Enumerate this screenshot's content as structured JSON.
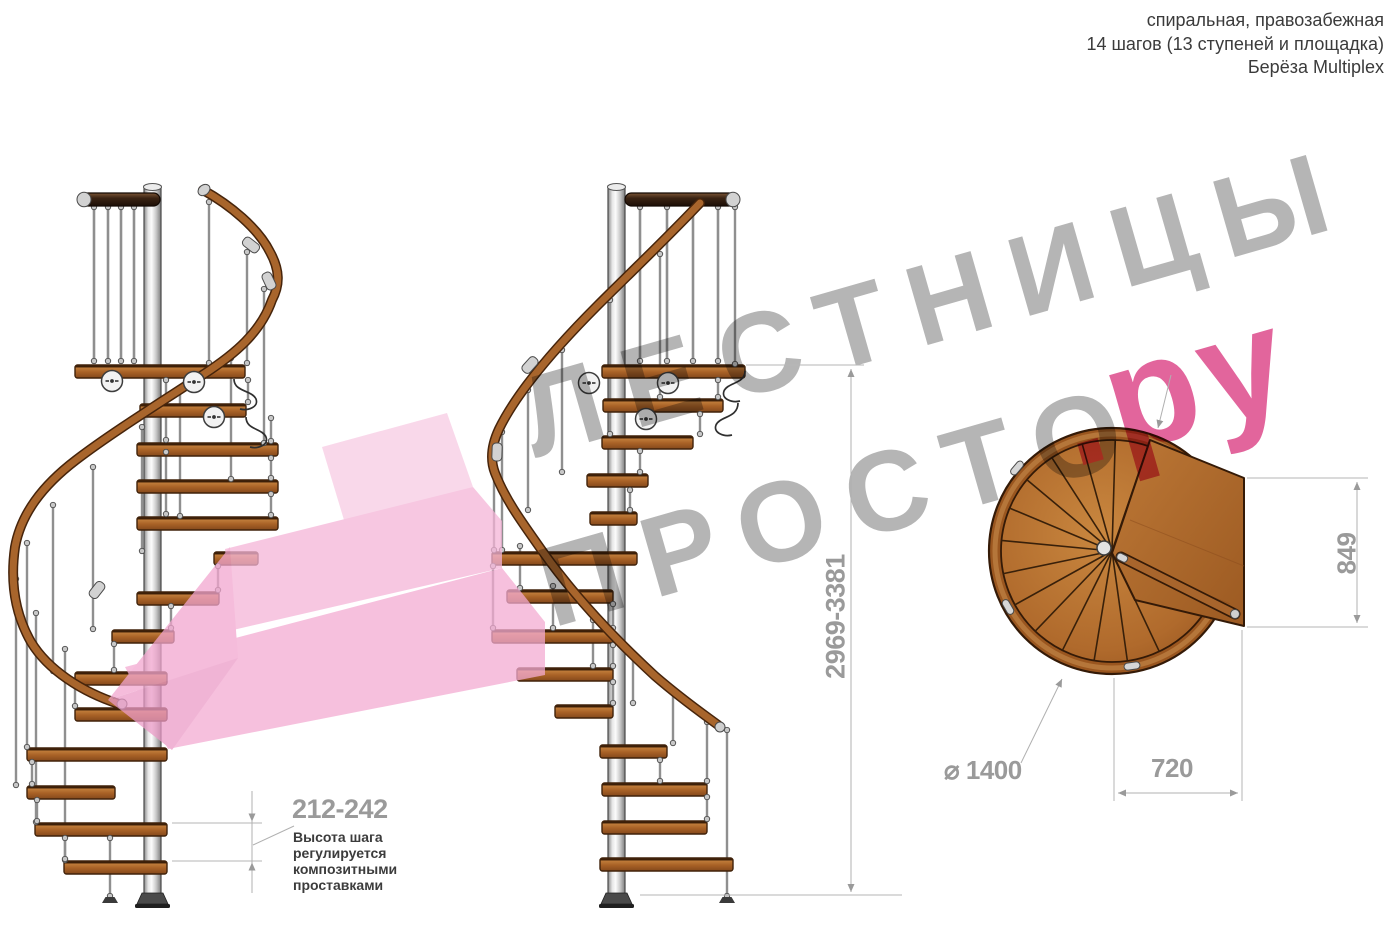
{
  "header": {
    "type_label": "спиральная, правозабежная",
    "steps_label": "14 шагов (13 ступеней и площадка)",
    "material_label": "Берёза Multiplex"
  },
  "watermark": {
    "word1": "ЛЕСТНИЦЫ",
    "word2": "ПРОСТО",
    "word3": ".ру",
    "gray_color": "#b5b5b5",
    "pink_color": "#e2659c"
  },
  "dimensions": {
    "total_height": "2969-3381",
    "step_height": "212-242",
    "landing_depth": "849",
    "landing_width": "720",
    "diameter_symbol": "⌀",
    "diameter_value": "1400"
  },
  "annotation": {
    "line1": "Высота шага",
    "line2": "регулируется",
    "line3": "композитными",
    "line4": "проставками"
  },
  "drawing": {
    "views": [
      "боковой вид 1",
      "боковой вид 2",
      "вид сверху"
    ],
    "colors": {
      "wood": "#a8652c",
      "wood_dark": "#46240b",
      "metal": "#c9c9c9",
      "dimension_lines": "#b0b0b0",
      "dimension_text": "#9a9a9a",
      "annotation_text": "#3c3c3c",
      "highlight_arrow": "#f5b5d8"
    }
  }
}
